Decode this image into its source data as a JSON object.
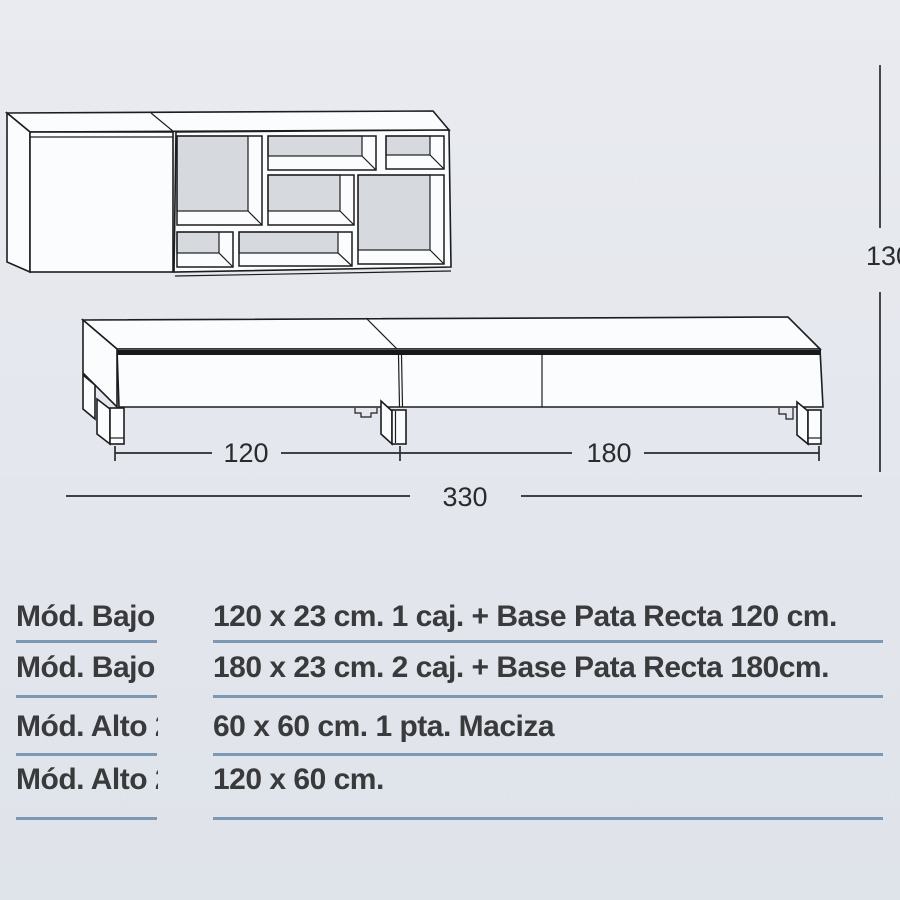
{
  "drawing": {
    "dimensions": {
      "left_module_width": "120",
      "right_module_width": "180",
      "total_width": "330",
      "total_height": "130"
    },
    "colors": {
      "line": "#1c1d1f",
      "panel": "#fbfcfd",
      "back_panel": "#d6dade"
    }
  },
  "table": {
    "separator_color": "#7d98b2",
    "text_color": "#393a3c",
    "rows": [
      {
        "label": "Mód. Bajo",
        "value": "120 x 23 cm. 1 caj. + Base Pata Recta 120 cm."
      },
      {
        "label": "Mód. Bajo",
        "value": "180 x 23 cm. 2 caj. + Base Pata Recta 180cm."
      },
      {
        "label": "Mód. Alto 2",
        "value": "60 x 60 cm. 1 pta. Maciza"
      },
      {
        "label": "Mód. Alto 2",
        "value": "120 x 60 cm."
      }
    ]
  }
}
